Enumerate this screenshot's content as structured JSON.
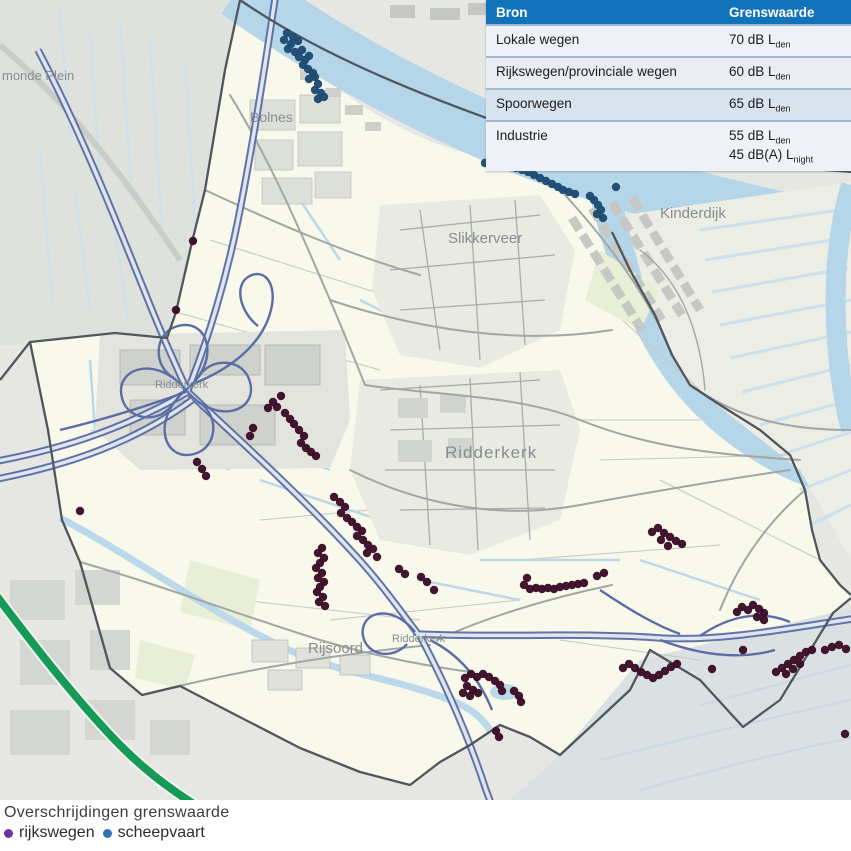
{
  "table": {
    "header": {
      "col1": "Bron",
      "col2": "Grenswaarde"
    },
    "header_bg": "#1173b9",
    "rows": [
      {
        "bron": "Lokale wegen",
        "limits": [
          {
            "text": "70 dB L",
            "sub": "den"
          }
        ]
      },
      {
        "bron": "Rijkswegen/provinciale wegen",
        "limits": [
          {
            "text": "60 dB L",
            "sub": "den"
          }
        ]
      },
      {
        "bron": "Spoorwegen",
        "limits": [
          {
            "text": "65 dB L",
            "sub": "den"
          }
        ]
      },
      {
        "bron": "Industrie",
        "limits": [
          {
            "text": "55 dB L",
            "sub": "den"
          },
          {
            "text": "45 dB(A) L",
            "sub": "night"
          }
        ]
      }
    ]
  },
  "legend": {
    "title": "Overschrijdingen grenswaarde",
    "items": [
      {
        "label": "rijkswegen",
        "color": "#7030a0"
      },
      {
        "label": "scheepvaart",
        "color": "#2e74b5"
      }
    ]
  },
  "map": {
    "place_labels": [
      {
        "text": "monde Plein",
        "x": 2,
        "y": 80,
        "size": 13,
        "big": false
      },
      {
        "text": "Bolnes",
        "x": 250,
        "y": 122,
        "size": 14,
        "big": false
      },
      {
        "text": "Slikkerveer",
        "x": 448,
        "y": 243,
        "size": 15,
        "big": false
      },
      {
        "text": "Kinderdijk",
        "x": 660,
        "y": 218,
        "size": 15,
        "big": false
      },
      {
        "text": "Ridderkerk",
        "x": 445,
        "y": 458,
        "size": 17,
        "big": true
      },
      {
        "text": "Ridderkerk",
        "x": 155,
        "y": 388,
        "size": 11,
        "big": false
      },
      {
        "text": "Ridderkerk",
        "x": 392,
        "y": 642,
        "size": 11,
        "big": false
      },
      {
        "text": "Rijsoord",
        "x": 308,
        "y": 653,
        "size": 15,
        "big": false
      }
    ],
    "dot_colors": {
      "rijkswegen": "#3b0d27",
      "scheepvaart": "#1c4a72"
    },
    "exceedance_points": {
      "rijkswegen": [
        [
          193,
          241
        ],
        [
          176,
          310
        ],
        [
          281,
          396
        ],
        [
          273,
          402
        ],
        [
          268,
          408
        ],
        [
          277,
          407
        ],
        [
          285,
          413
        ],
        [
          290,
          419
        ],
        [
          294,
          424
        ],
        [
          299,
          430
        ],
        [
          304,
          436
        ],
        [
          301,
          443
        ],
        [
          306,
          448
        ],
        [
          311,
          452
        ],
        [
          316,
          456
        ],
        [
          253,
          428
        ],
        [
          250,
          436
        ],
        [
          197,
          462
        ],
        [
          202,
          469
        ],
        [
          206,
          476
        ],
        [
          80,
          511
        ],
        [
          334,
          497
        ],
        [
          340,
          502
        ],
        [
          345,
          507
        ],
        [
          341,
          513
        ],
        [
          347,
          518
        ],
        [
          352,
          522
        ],
        [
          357,
          527
        ],
        [
          362,
          531
        ],
        [
          357,
          536
        ],
        [
          363,
          540
        ],
        [
          368,
          545
        ],
        [
          373,
          549
        ],
        [
          367,
          553
        ],
        [
          377,
          557
        ],
        [
          322,
          548
        ],
        [
          318,
          553
        ],
        [
          324,
          558
        ],
        [
          320,
          563
        ],
        [
          316,
          568
        ],
        [
          322,
          573
        ],
        [
          318,
          578
        ],
        [
          324,
          582
        ],
        [
          320,
          587
        ],
        [
          317,
          592
        ],
        [
          323,
          597
        ],
        [
          319,
          602
        ],
        [
          325,
          606
        ],
        [
          399,
          569
        ],
        [
          405,
          574
        ],
        [
          421,
          577
        ],
        [
          427,
          582
        ],
        [
          434,
          590
        ],
        [
          524,
          585
        ],
        [
          530,
          589
        ],
        [
          536,
          588
        ],
        [
          542,
          589
        ],
        [
          548,
          588
        ],
        [
          554,
          589
        ],
        [
          560,
          587
        ],
        [
          566,
          586
        ],
        [
          572,
          585
        ],
        [
          578,
          584
        ],
        [
          584,
          583
        ],
        [
          527,
          578
        ],
        [
          597,
          576
        ],
        [
          604,
          573
        ],
        [
          652,
          532
        ],
        [
          658,
          528
        ],
        [
          664,
          533
        ],
        [
          670,
          537
        ],
        [
          676,
          541
        ],
        [
          682,
          544
        ],
        [
          661,
          540
        ],
        [
          668,
          546
        ],
        [
          465,
          678
        ],
        [
          471,
          674
        ],
        [
          477,
          677
        ],
        [
          483,
          674
        ],
        [
          489,
          677
        ],
        [
          495,
          681
        ],
        [
          500,
          685
        ],
        [
          467,
          686
        ],
        [
          473,
          690
        ],
        [
          463,
          693
        ],
        [
          470,
          696
        ],
        [
          478,
          693
        ],
        [
          502,
          691
        ],
        [
          514,
          691
        ],
        [
          519,
          696
        ],
        [
          521,
          702
        ],
        [
          496,
          731
        ],
        [
          499,
          737
        ],
        [
          737,
          612
        ],
        [
          742,
          607
        ],
        [
          748,
          610
        ],
        [
          753,
          605
        ],
        [
          759,
          609
        ],
        [
          764,
          613
        ],
        [
          757,
          617
        ],
        [
          764,
          620
        ],
        [
          743,
          650
        ],
        [
          623,
          668
        ],
        [
          629,
          664
        ],
        [
          635,
          668
        ],
        [
          641,
          672
        ],
        [
          647,
          675
        ],
        [
          653,
          678
        ],
        [
          659,
          675
        ],
        [
          665,
          671
        ],
        [
          671,
          667
        ],
        [
          677,
          664
        ],
        [
          712,
          669
        ],
        [
          776,
          672
        ],
        [
          782,
          668
        ],
        [
          788,
          664
        ],
        [
          794,
          660
        ],
        [
          800,
          656
        ],
        [
          806,
          652
        ],
        [
          812,
          650
        ],
        [
          786,
          674
        ],
        [
          793,
          669
        ],
        [
          800,
          664
        ],
        [
          825,
          650
        ],
        [
          832,
          647
        ],
        [
          839,
          645
        ],
        [
          846,
          649
        ],
        [
          845,
          734
        ]
      ],
      "scheepvaart": [
        [
          287,
          33
        ],
        [
          293,
          37
        ],
        [
          284,
          40
        ],
        [
          291,
          44
        ],
        [
          298,
          41
        ],
        [
          288,
          49
        ],
        [
          295,
          52
        ],
        [
          302,
          50
        ],
        [
          299,
          57
        ],
        [
          305,
          60
        ],
        [
          309,
          56
        ],
        [
          303,
          65
        ],
        [
          308,
          69
        ],
        [
          313,
          73
        ],
        [
          309,
          79
        ],
        [
          315,
          77
        ],
        [
          318,
          84
        ],
        [
          315,
          90
        ],
        [
          321,
          93
        ],
        [
          318,
          99
        ],
        [
          324,
          97
        ],
        [
          485,
          163
        ],
        [
          492,
          161
        ],
        [
          498,
          164
        ],
        [
          504,
          162
        ],
        [
          510,
          166
        ],
        [
          516,
          168
        ],
        [
          522,
          170
        ],
        [
          528,
          172
        ],
        [
          534,
          175
        ],
        [
          540,
          178
        ],
        [
          546,
          181
        ],
        [
          552,
          184
        ],
        [
          558,
          187
        ],
        [
          563,
          190
        ],
        [
          569,
          192
        ],
        [
          575,
          194
        ],
        [
          590,
          196
        ],
        [
          594,
          200
        ],
        [
          598,
          205
        ],
        [
          601,
          210
        ],
        [
          597,
          214
        ],
        [
          603,
          218
        ],
        [
          616,
          187
        ]
      ]
    }
  }
}
